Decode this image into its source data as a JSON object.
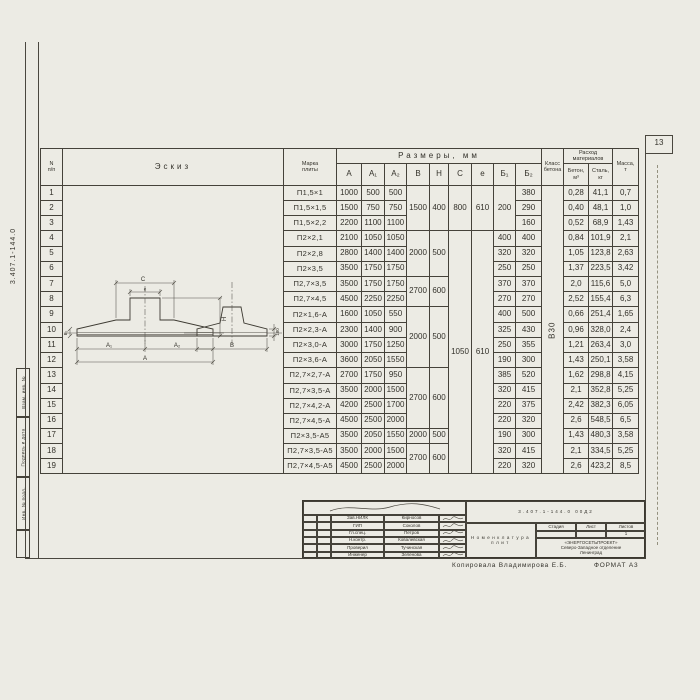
{
  "page": {
    "number": "13",
    "copied_by": "Копировала Владимирова Е.Б.",
    "format": "ФОРМАТ А3"
  },
  "margin": {
    "code": "3.407.1-144.0",
    "stamps": [
      "Взам. инв. №",
      "Подпись и дата",
      "Инв. № подл."
    ]
  },
  "table": {
    "headers": {
      "num_top": "N",
      "num_bottom": "п/п",
      "sketch": "Эскиз",
      "mark_top": "Марка",
      "mark_bottom": "плиты",
      "sizes": "Размеры,  мм",
      "size_cols": [
        "А",
        "А₁",
        "А₂",
        "В",
        "Н",
        "С",
        "е",
        "Б₁",
        "Б₂"
      ],
      "class_top": "Класс",
      "class_bottom": "бетона",
      "consumption_top": "Расход",
      "consumption_bottom": "материалов",
      "concrete_top": "Бетон,",
      "concrete_bottom": "м³",
      "steel_top": "Сталь,",
      "steel_bottom": "кг",
      "mass_top": "Масса,",
      "mass_bottom": "т"
    },
    "concrete_class": "В30",
    "rows": [
      {
        "n": "1",
        "mark": "П1,5×1",
        "A": "1000",
        "A1": "500",
        "A2": "500",
        "B": "1500",
        "H": "400",
        "C": "800",
        "e": "610",
        "b1": "200",
        "b2": "380",
        "beton": "0,28",
        "steel": "41,1",
        "mass": "0,7"
      },
      {
        "n": "2",
        "mark": "П1,5×1,5",
        "A": "1500",
        "A1": "750",
        "A2": "750",
        "b2": "290",
        "beton": "0,40",
        "steel": "48,1",
        "mass": "1,0"
      },
      {
        "n": "3",
        "mark": "П1,5×2,2",
        "A": "2200",
        "A1": "1100",
        "A2": "1100",
        "b2": "160",
        "beton": "0,52",
        "steel": "68,9",
        "mass": "1,43"
      },
      {
        "n": "4",
        "mark": "П2×2,1",
        "A": "2100",
        "A1": "1050",
        "A2": "1050",
        "B": "2000",
        "H": "500",
        "C": "1050",
        "e": "610",
        "b1": "400",
        "b2": "400",
        "beton": "0,84",
        "steel": "101,9",
        "mass": "2,1"
      },
      {
        "n": "5",
        "mark": "П2×2,8",
        "A": "2800",
        "A1": "1400",
        "A2": "1400",
        "b1": "320",
        "b2": "320",
        "beton": "1,05",
        "steel": "123,8",
        "mass": "2,63"
      },
      {
        "n": "6",
        "mark": "П2×3,5",
        "A": "3500",
        "A1": "1750",
        "A2": "1750",
        "b1": "250",
        "b2": "250",
        "beton": "1,37",
        "steel": "223,5",
        "mass": "3,42"
      },
      {
        "n": "7",
        "mark": "П2,7×3,5",
        "A": "3500",
        "A1": "1750",
        "A2": "1750",
        "B": "2700",
        "H": "600",
        "b1": "370",
        "b2": "370",
        "beton": "2,0",
        "steel": "115,6",
        "mass": "5,0"
      },
      {
        "n": "8",
        "mark": "П2,7×4,5",
        "A": "4500",
        "A1": "2250",
        "A2": "2250",
        "b1": "270",
        "b2": "270",
        "beton": "2,52",
        "steel": "155,4",
        "mass": "6,3"
      },
      {
        "n": "9",
        "mark": "П2×1,6-А",
        "A": "1600",
        "A1": "1050",
        "A2": "550",
        "B": "2000",
        "H": "500",
        "b1": "400",
        "b2": "500",
        "beton": "0,66",
        "steel": "251,4",
        "mass": "1,65"
      },
      {
        "n": "10",
        "mark": "П2×2,3-А",
        "A": "2300",
        "A1": "1400",
        "A2": "900",
        "b1": "325",
        "b2": "430",
        "beton": "0,96",
        "steel": "328,0",
        "mass": "2,4"
      },
      {
        "n": "11",
        "mark": "П2×3,0-А",
        "A": "3000",
        "A1": "1750",
        "A2": "1250",
        "b1": "250",
        "b2": "355",
        "beton": "1,21",
        "steel": "263,4",
        "mass": "3,0"
      },
      {
        "n": "12",
        "mark": "П2×3,6-А",
        "A": "3600",
        "A1": "2050",
        "A2": "1550",
        "b1": "190",
        "b2": "300",
        "beton": "1,43",
        "steel": "250,1",
        "mass": "3,58"
      },
      {
        "n": "13",
        "mark": "П2,7×2,7-А",
        "A": "2700",
        "A1": "1750",
        "A2": "950",
        "B": "2700",
        "H": "600",
        "b1": "385",
        "b2": "520",
        "beton": "1,62",
        "steel": "298,8",
        "mass": "4,15"
      },
      {
        "n": "14",
        "mark": "П2,7×3,5-А",
        "A": "3500",
        "A1": "2000",
        "A2": "1500",
        "b1": "320",
        "b2": "415",
        "beton": "2,1",
        "steel": "352,8",
        "mass": "5,25"
      },
      {
        "n": "15",
        "mark": "П2,7×4,2-А",
        "A": "4200",
        "A1": "2500",
        "A2": "1700",
        "b1": "220",
        "b2": "375",
        "beton": "2,42",
        "steel": "382,3",
        "mass": "6,05"
      },
      {
        "n": "16",
        "mark": "П2,7×4,5-А",
        "A": "4500",
        "A1": "2500",
        "A2": "2000",
        "b1": "220",
        "b2": "320",
        "beton": "2,6",
        "steel": "548,5",
        "mass": "6,5"
      },
      {
        "n": "17",
        "mark": "П2×3,5-А5",
        "A": "3500",
        "A1": "2050",
        "A2": "1550",
        "B": "2000",
        "H": "500",
        "b1": "190",
        "b2": "300",
        "beton": "1,43",
        "steel": "480,3",
        "mass": "3,58"
      },
      {
        "n": "18",
        "mark": "П2,7×3,5-А5",
        "A": "3500",
        "A1": "2000",
        "A2": "1500",
        "B": "2700",
        "H": "600",
        "b1": "320",
        "b2": "415",
        "beton": "2,1",
        "steel": "334,5",
        "mass": "5,25"
      },
      {
        "n": "19",
        "mark": "П2,7×4,5-А5",
        "A": "4500",
        "A1": "2500",
        "A2": "2000",
        "b1": "220",
        "b2": "320",
        "beton": "2,6",
        "steel": "423,2",
        "mass": "8,5"
      }
    ]
  },
  "sketch_labels": {
    "c": "С",
    "e": "е",
    "a1": "А₁",
    "a2": "А₂",
    "a": "А",
    "h": "Н",
    "b": "В",
    "t180": "180",
    "edge": "Б₂"
  },
  "title_block": {
    "doc_number": "3.407.1-144.0   00Д2",
    "title_line1": "Номенклатура",
    "title_line2": "плит",
    "stage_label": "Стадия",
    "sheet_label": "Лист",
    "sheets_label": "Листов",
    "sheets_value": "1",
    "org_line1": "«ЭНЕРГОСЕТЬПРОЕКТ»",
    "org_line2": "Северо-Западное отделение",
    "org_line3": "Ленинград",
    "people": [
      {
        "role": "Зав.НИЛК",
        "name": "Кирносов"
      },
      {
        "role": "ГИП",
        "name": "Соколов"
      },
      {
        "role": "Гл.спец.",
        "name": "Петров"
      },
      {
        "role": "Н.контр.",
        "name": "Ковалевская"
      },
      {
        "role": "Проверил",
        "name": "Тучинская"
      },
      {
        "role": "Инженер",
        "name": "Зеленова"
      }
    ]
  }
}
